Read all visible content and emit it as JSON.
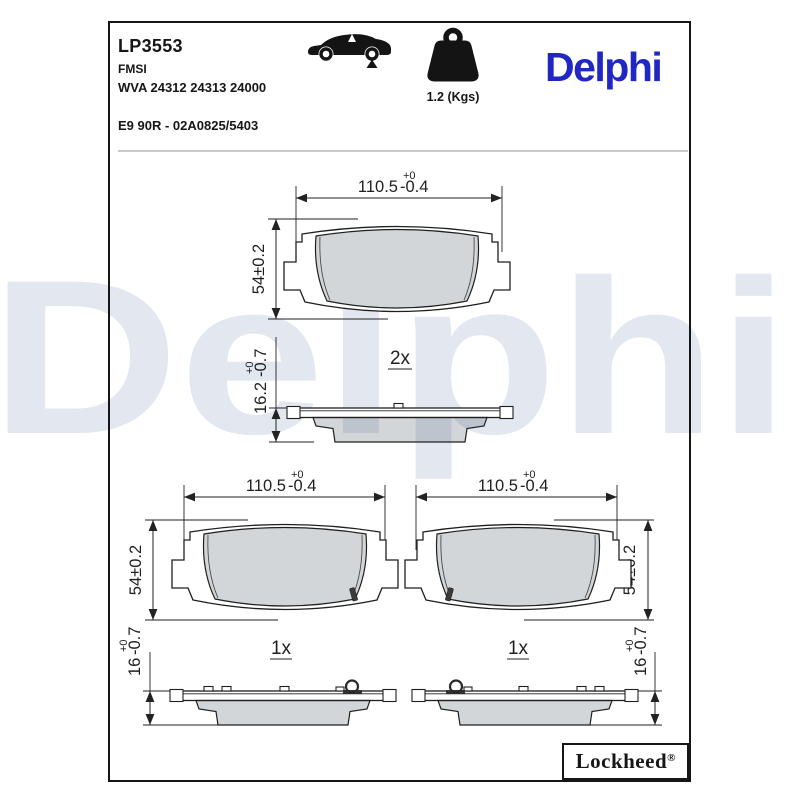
{
  "header": {
    "part_number": "LP3553",
    "fmsi_label": "FMSI",
    "wva_numbers": "WVA 24312 24313 24000",
    "homologation": "E9 90R - 02A0825/5403",
    "weight": "1.2 (Kgs)",
    "brand_logo": "Delphi"
  },
  "icons": {
    "car": "car-rear-axle-icon",
    "weight": "weight-icon"
  },
  "watermark": "Delphi",
  "footer": {
    "lockheed": "Lockheed",
    "registered": "®"
  },
  "drawings": {
    "pad_top": {
      "width": "110.5",
      "width_tol_upper": "+0",
      "width_tol_lower": "-0.4",
      "height": "54±0.2"
    },
    "profile_double": {
      "qty": "2x",
      "thickness": "16.2",
      "thick_tol_upper": "+0",
      "thick_tol_lower": "-0.7"
    },
    "pad_left": {
      "width": "110.5",
      "width_tol_upper": "+0",
      "width_tol_lower": "-0.4",
      "height": "54±0.2"
    },
    "pad_right": {
      "width": "110.5",
      "width_tol_upper": "+0",
      "width_tol_lower": "-0.4",
      "height": "54±0.2"
    },
    "profile_left": {
      "qty": "1x",
      "thickness": "16",
      "thick_tol_upper": "+0",
      "thick_tol_lower": "-0.7"
    },
    "profile_right": {
      "qty": "1x",
      "thickness": "16",
      "thick_tol_upper": "+0",
      "thick_tol_lower": "-0.7"
    }
  },
  "colors": {
    "delphi_blue": "#2127c4",
    "watermark": "#e2e7f0",
    "line": "#1f1f1f",
    "friction_gray": "#d5d8dc"
  }
}
